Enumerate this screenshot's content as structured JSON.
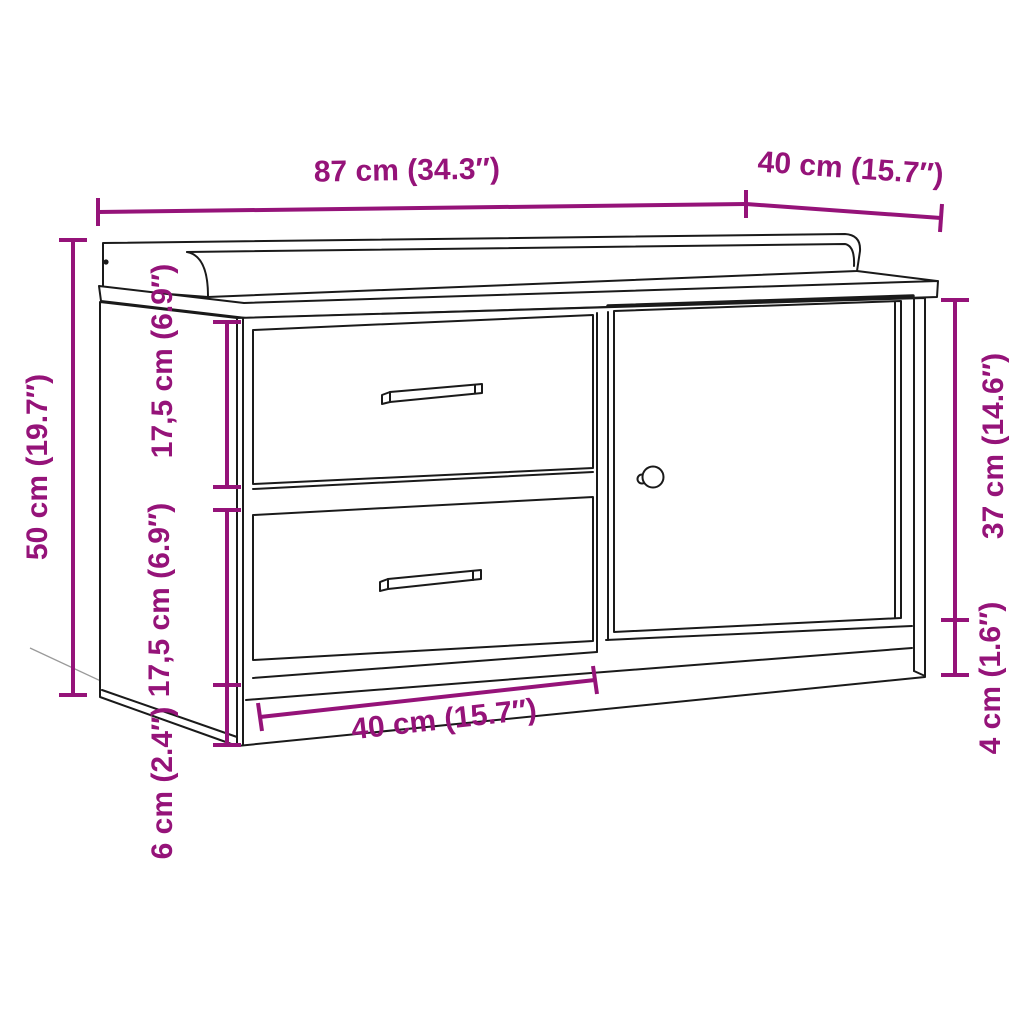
{
  "diagram": {
    "type": "furniture-dimension-diagram",
    "subject": "storage bench with two drawers and one door",
    "colors": {
      "dimension": "#951379",
      "outline": "#1a1a1a",
      "background": "#ffffff"
    },
    "dimensions": {
      "total_width": {
        "label": "87 cm (34.3″)"
      },
      "total_depth": {
        "label": "40 cm (15.7″)"
      },
      "total_height": {
        "label": "50 cm (19.7″)"
      },
      "drawer_top_height": {
        "label": "17,5 cm (6.9″)"
      },
      "drawer_bottom_height": {
        "label": "17,5 cm (6.9″)"
      },
      "plinth_height_left": {
        "label": "6 cm (2.4″)"
      },
      "drawer_section_width": {
        "label": "40 cm (15.7″)"
      },
      "door_height": {
        "label": "37 cm (14.6″)"
      },
      "plinth_height_right": {
        "label": "4 cm (1.6″)"
      }
    }
  }
}
